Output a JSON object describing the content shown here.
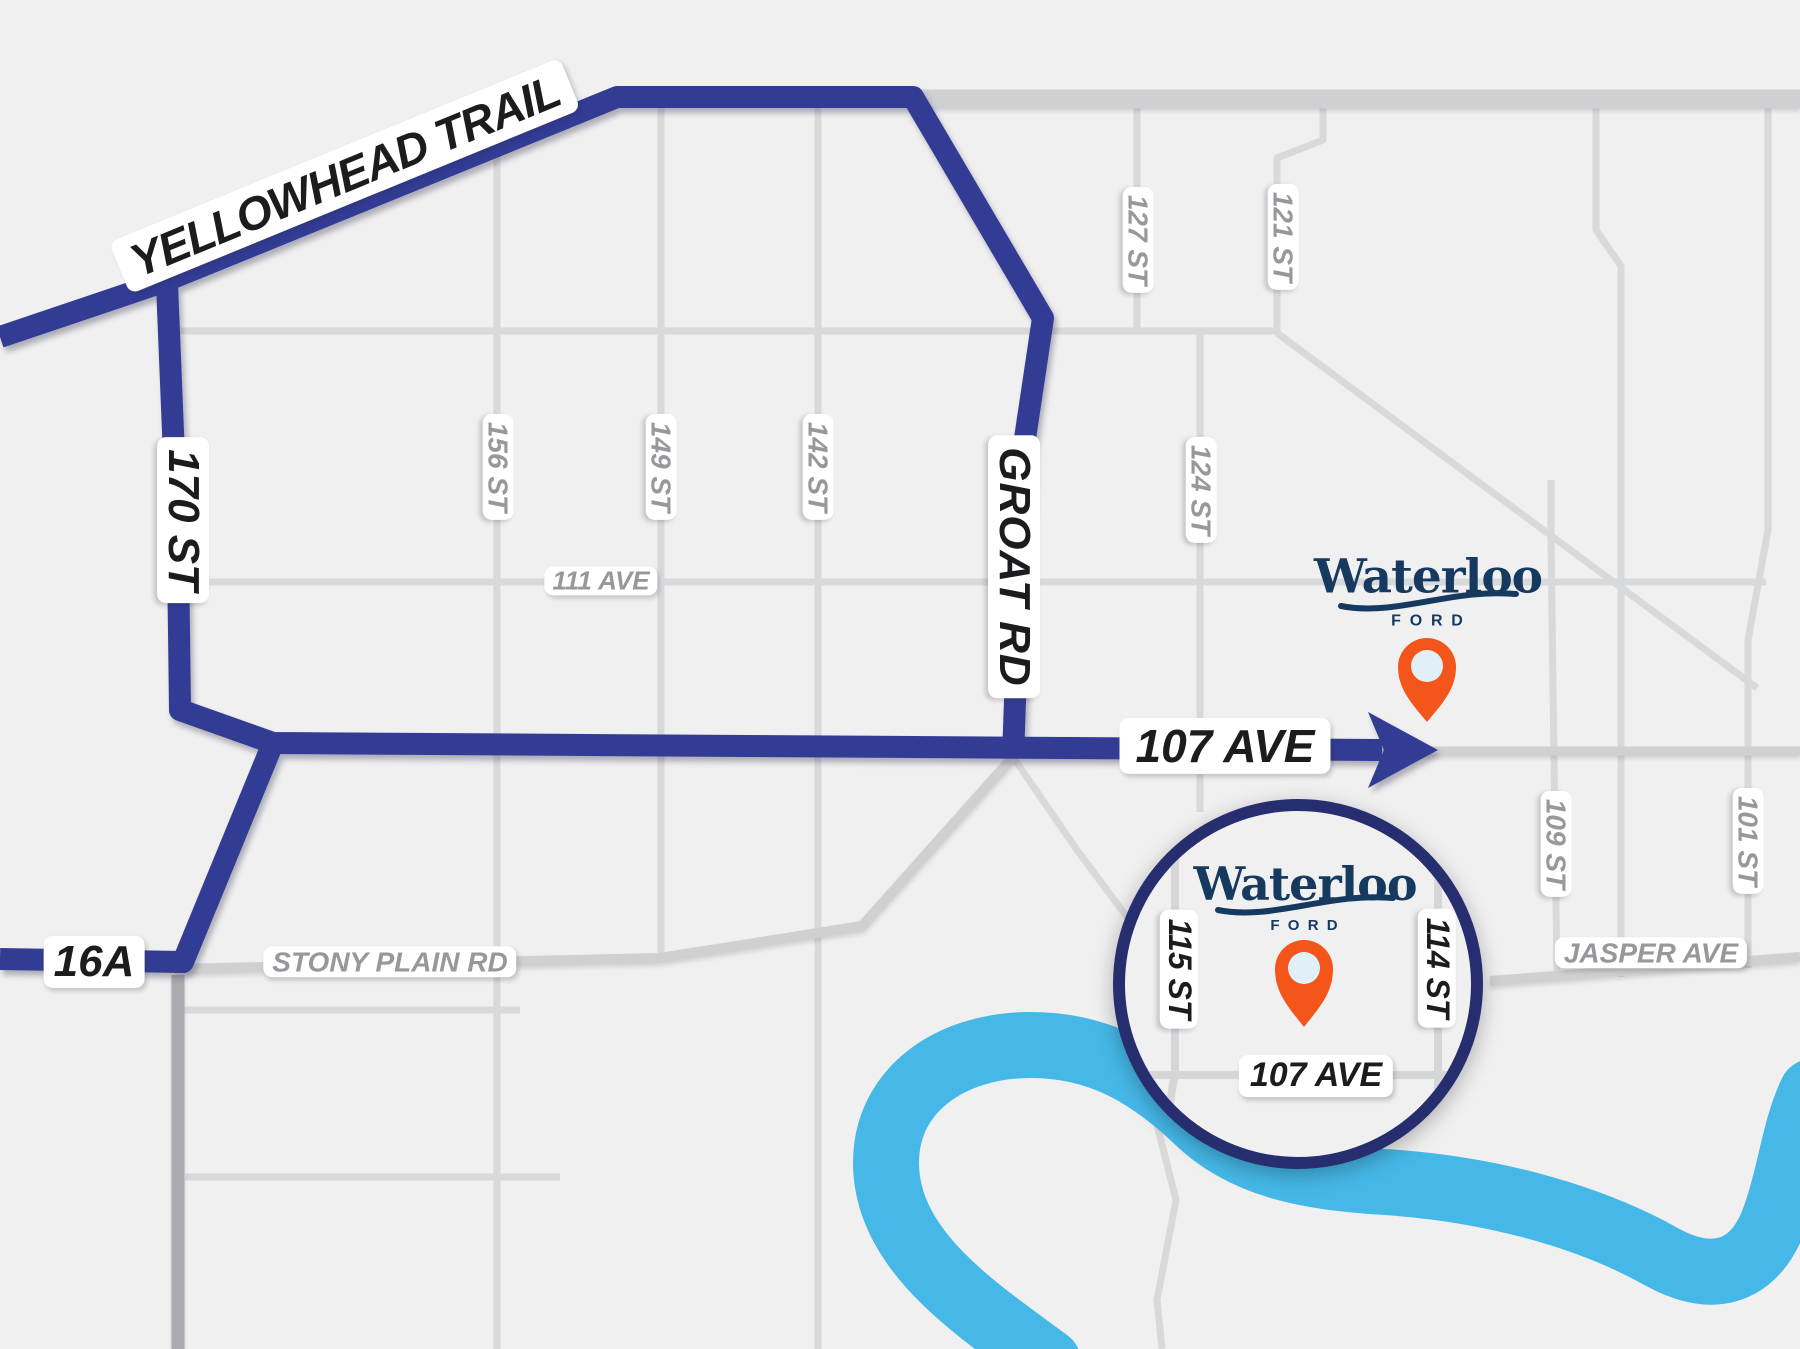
{
  "colors": {
    "background": "#F0F0F1",
    "route_blue": "#323C94",
    "inset_ring": "#272E6F",
    "river_blue": "#45B8E8",
    "brand_navy": "#16395F",
    "pin_orange": "#F4551A",
    "pin_inner": "#E1EFF8",
    "road_gray": "#D8D9DB",
    "road_gray_major": "#CFD0D2",
    "road_gray_dark": "#A9ABAE",
    "label_gray": "#96989C",
    "label_black": "#1C1C1E"
  },
  "route_labels": {
    "yellowhead_trail": "YELLOWHEAD TRAIL",
    "st_170": "170 ST",
    "groat_rd": "GROAT RD",
    "ave_107": "107 AVE",
    "hwy_16a": "16A"
  },
  "street_labels": {
    "st_156": "156 ST",
    "st_149": "149 ST",
    "st_142": "142 ST",
    "st_127": "127 ST",
    "st_124": "124 ST",
    "st_121": "121 ST",
    "st_109": "109 ST",
    "st_101": "101 ST",
    "ave_111": "111 AVE",
    "stony_plain_rd": "STONY PLAIN RD",
    "jasper_ave": "JASPER AVE"
  },
  "inset": {
    "st_115": "115 ST",
    "st_114": "114 ST",
    "ave_107": "107 AVE"
  },
  "brand": {
    "wordmark": "Waterloo",
    "division": "FORD"
  }
}
